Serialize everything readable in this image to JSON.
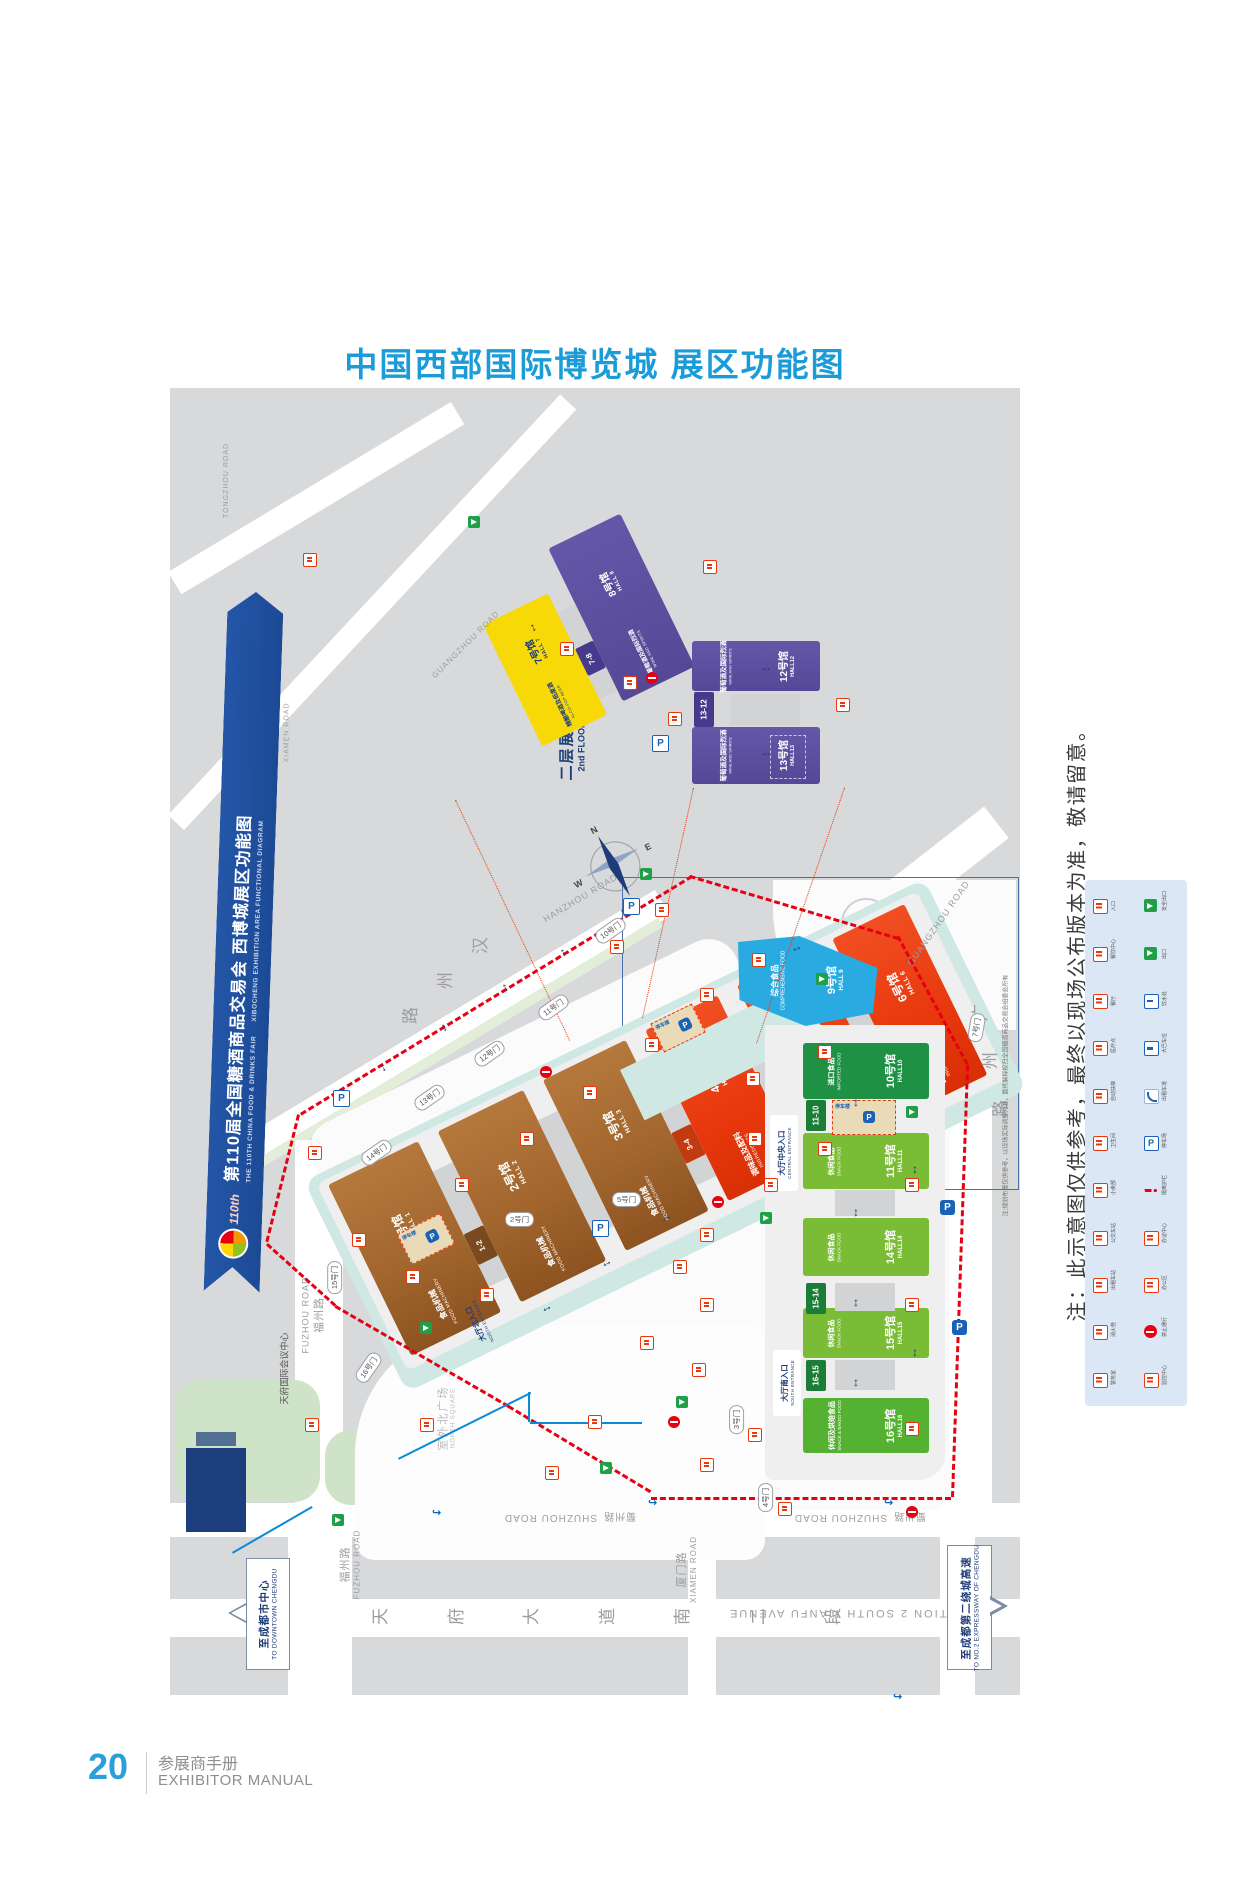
{
  "page": {
    "title": "中国西部国际博览城 展区功能图",
    "page_no": "20",
    "footer_cn": "参展商手册",
    "footer_en": "EXHIBITOR MANUAL"
  },
  "notes": {
    "side": "注：此示意图仅供参考，最终以现场公布版本为准，敬请留意。",
    "map": "注:规划布置仅供参考，以现场实际调整为准，最终解释权归全国糖酒商品交易会组委会所有"
  },
  "banner": {
    "cn": "第110届全国糖酒商品交易会 西博城展区功能图",
    "en": "THE 110TH CHINA FOOD & DRINKS FAIR　　XIBOCHENG EXHIBITION AREA FUNCTIONAL DIAGRAM",
    "logo": "110th"
  },
  "inset": {
    "cn": "二层展区",
    "en": "2nd FLOOR"
  },
  "compass": {
    "n": "N",
    "e": "E",
    "s": "S",
    "w": "W"
  },
  "halls": {
    "h1": {
      "no": "1号馆",
      "en": "HALL 1",
      "cat": "食品机械",
      "cat_en": "FOOD MACHINERY"
    },
    "h2": {
      "no": "2号馆",
      "en": "HALL 2",
      "cat": "食品机械",
      "cat_en": "FOOD MACHINERY"
    },
    "h3": {
      "no": "3号馆",
      "en": "HALL 3",
      "cat": "食品机械",
      "cat_en": "FOOD MACHINERY"
    },
    "h4": {
      "no": "4号馆",
      "en": "HALL 4",
      "cat": "调味品及配料",
      "cat_en": "INGREDIENTS"
    },
    "h5": {
      "no": "5号馆",
      "en": "HALL 5",
      "cat": "调味品及配料",
      "cat_en": "INGREDIENTS"
    },
    "h6": {
      "no": "6号馆",
      "en": "HALL 6",
      "cat": "调味品及配料",
      "cat_en": "INGREDIENTS"
    },
    "h7": {
      "no": "7号馆",
      "en": "HALL 7",
      "cat": "精酿啤酒及低度酒",
      "cat_en": "ALCO-POP BEER"
    },
    "h8": {
      "no": "8号馆",
      "en": "HALL 8",
      "cat": "葡萄酒及国际烈酒",
      "cat_en": "WINE AND SPIRITS"
    },
    "h9": {
      "no": "9号馆",
      "en": "HALL 9",
      "cat": "综合食品",
      "cat_en": "COMPREHENSIVE FOOD"
    },
    "h10": {
      "no": "10号馆",
      "en": "HALL10",
      "cat": "进口食品",
      "cat_en": "IMPORTED FOOD"
    },
    "h11": {
      "no": "11号馆",
      "en": "HALL11",
      "cat": "休闲食品",
      "cat_en": "SNACK FOOD"
    },
    "h12": {
      "no": "12号馆",
      "en": "HALL12",
      "cat": "葡萄酒及国际烈酒",
      "cat_en": "WINE AND SPIRITS"
    },
    "h13": {
      "no": "13号馆",
      "en": "HALL13",
      "cat": "葡萄酒及国际烈酒",
      "cat_en": "WINE AND SPIRITS"
    },
    "h14": {
      "no": "14号馆",
      "en": "HALL14",
      "cat": "休闲食品",
      "cat_en": "SNACK FOOD"
    },
    "h15": {
      "no": "15号馆",
      "en": "HALL15",
      "cat": "休闲食品",
      "cat_en": "SNACK FOOD"
    },
    "h16": {
      "no": "16号馆",
      "en": "HALL16",
      "cat": "休闲及烘焙食品",
      "cat_en": "SNACK & BAKED FOOD"
    }
  },
  "connectors": {
    "c12": "1-2",
    "c34": "3-4",
    "c56": "5-6",
    "c78": "7-8",
    "c1312": "13-12",
    "c1110": "11-10",
    "c1514": "15-14",
    "c1615": "16-15"
  },
  "gates": {
    "g2": "2号门",
    "g3": "3号门",
    "g4": "4号门",
    "g5": "5号门",
    "g7": "7号门",
    "g10": "10号门",
    "g11": "11号门",
    "g12": "12号门",
    "g13": "13号门",
    "g14": "14号门",
    "g15": "15号门",
    "g16": "16号门"
  },
  "roads": {
    "tongzhou_en": "TONGZHOU ROAD",
    "hanzhou_cn": "汉州路",
    "hanzhou_en": "HANZHOU ROAD",
    "guangzhou_cn": "广州路",
    "guangzhou_en": "GUANGZHOU ROAD",
    "fuzhou_cn": "福州路",
    "fuzhou_en": "FUZHOU ROAD",
    "shuzhou_cn": "蜀州路",
    "shuzhou_en": "SHUZHOU ROAD",
    "xiamen_cn": "厦门路",
    "xiamen_en": "XIAMEN ROAD",
    "tianfu_cn": "天府大道南二段",
    "tianfu_en": "SECTION 2 SOUTH TIANFU AVENUE"
  },
  "places": {
    "north_sq_cn": "室外北广场",
    "north_sq_en": "NORTH SQUARE",
    "conf_center": "天府国际会议中心",
    "parking_deck": "停车楼"
  },
  "entrances": {
    "central_cn": "大厅中央入口",
    "central_en": "CENTRAL ENTRANCE",
    "south_cn": "大厅南入口",
    "south_en": "SOUTH ENTRANCE",
    "north_cn": "大厅北入口",
    "north_en": "NORTH ENTRANCE"
  },
  "directions": {
    "left_cn": "至成都市中心",
    "left_en": "TO DOWNTOWN CHENGDU",
    "right_cn": "至成都第二绕城高速",
    "right_en": "TO NO.2 EXPRESSWAY OF CHENGDU"
  },
  "icons": {
    "parking": "P",
    "updown": "↕",
    "leftright": "↔",
    "turn": "↪"
  },
  "legend": {
    "items": [
      {
        "cn": "入口",
        "type": "red"
      },
      {
        "cn": "安全出口",
        "type": "green"
      },
      {
        "cn": "餐饮中心",
        "type": "red"
      },
      {
        "cn": "出口",
        "type": "green"
      },
      {
        "cn": "餐厅",
        "type": "red"
      },
      {
        "cn": "饮水处",
        "type": "blue"
      },
      {
        "cn": "医疗点",
        "type": "red"
      },
      {
        "cn": "大巴车位",
        "type": "blue"
      },
      {
        "cn": "自动扶梯",
        "type": "red"
      },
      {
        "cn": "出租车道",
        "type": "swoosh"
      },
      {
        "cn": "卫生间",
        "type": "red"
      },
      {
        "cn": "停车场",
        "type": "bluep"
      },
      {
        "cn": "小卖部",
        "type": "red"
      },
      {
        "cn": "隔离护栏",
        "type": "line"
      },
      {
        "cn": "公交车站",
        "type": "red"
      },
      {
        "cn": "办证中心",
        "type": "red"
      },
      {
        "cn": "出租车站",
        "type": "red"
      },
      {
        "cn": "办公区",
        "type": "red"
      },
      {
        "cn": "消火栓",
        "type": "red"
      },
      {
        "cn": "禁止通行",
        "type": "noentry"
      },
      {
        "cn": "警务室",
        "type": "red"
      },
      {
        "cn": "监控中心",
        "type": "red"
      }
    ]
  }
}
